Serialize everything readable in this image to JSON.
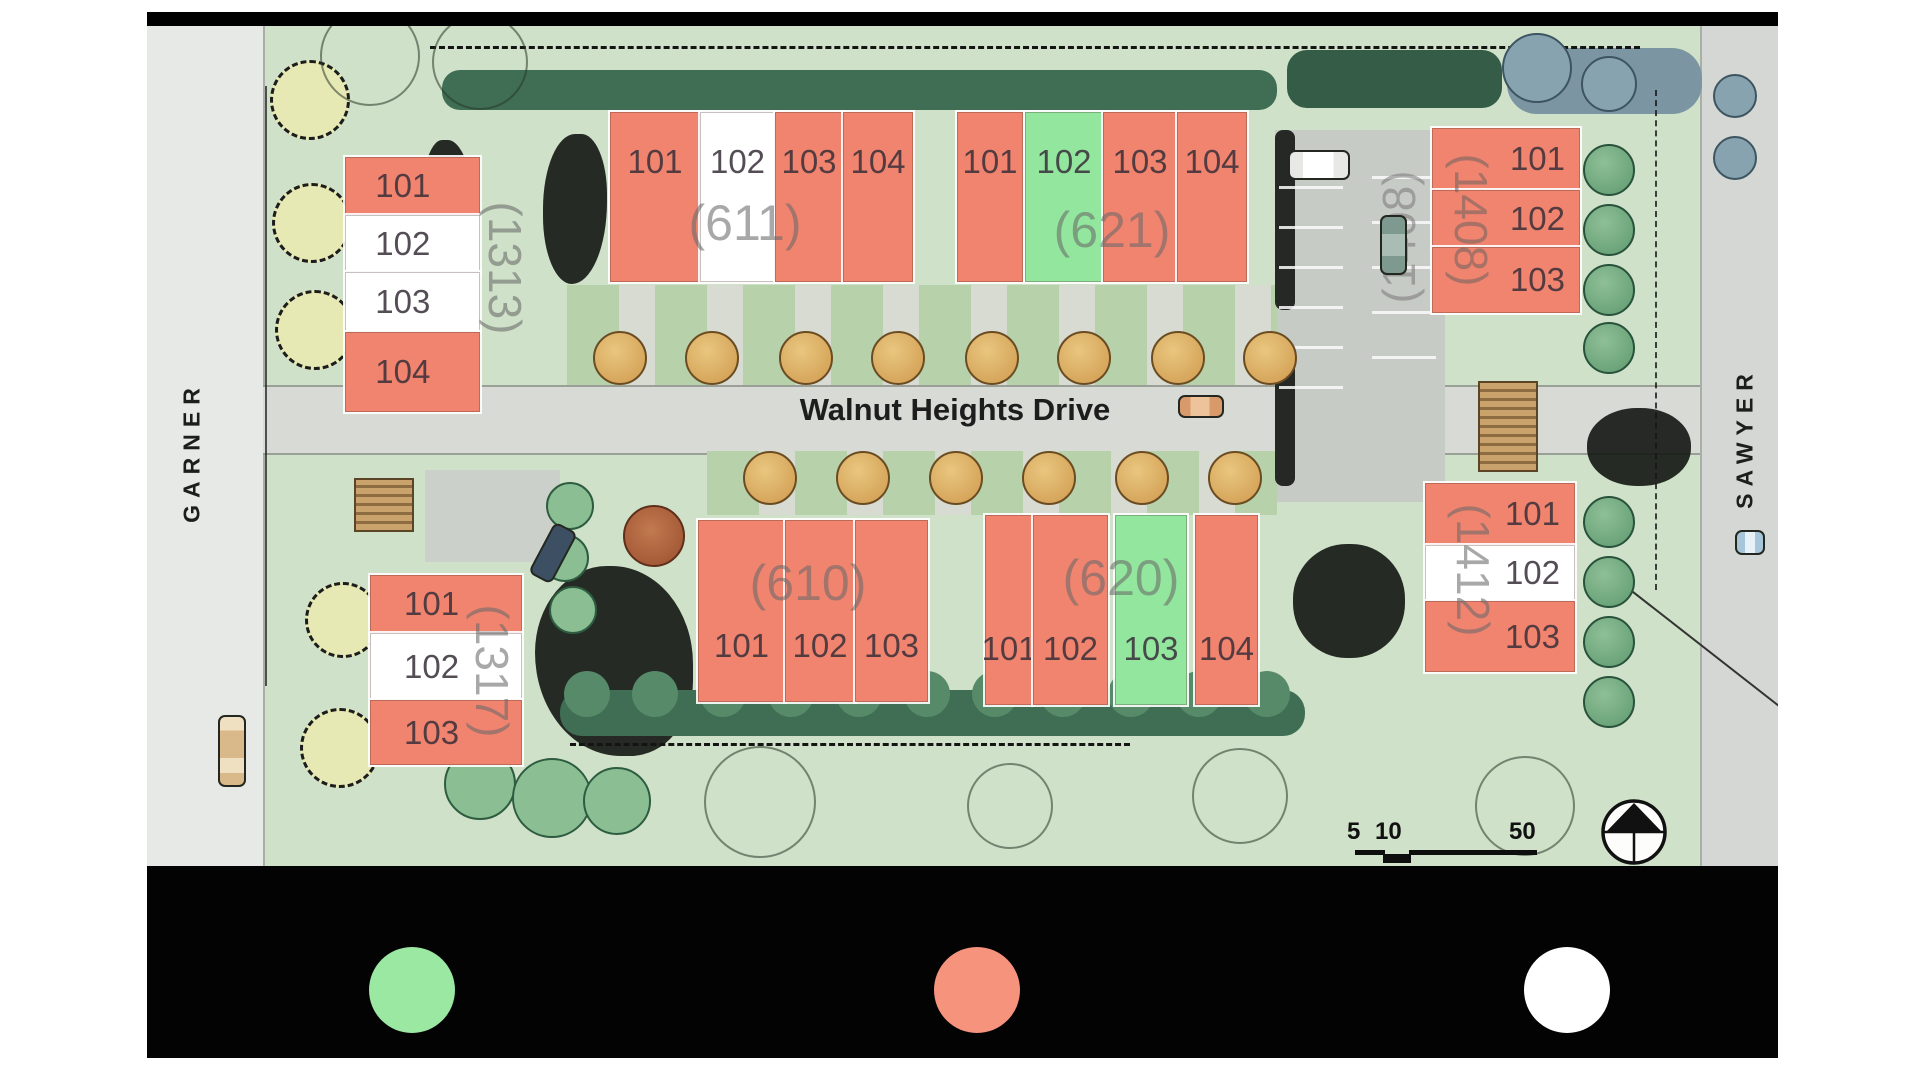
{
  "colors": {
    "salmon": "#F1846F",
    "green": "#93E69E",
    "white": "#FFFFFF"
  },
  "streets": {
    "left": "GARNER",
    "right": "SAWYER",
    "main": "Walnut Heights Drive"
  },
  "scale": {
    "labels": [
      "5",
      "10",
      "50"
    ]
  },
  "buildings": [
    {
      "id": "1313",
      "label": "(1313)",
      "units": [
        {
          "number": "101",
          "status": "salmon"
        },
        {
          "number": "102",
          "status": "white"
        },
        {
          "number": "103",
          "status": "white"
        },
        {
          "number": "104",
          "status": "salmon"
        }
      ]
    },
    {
      "id": "611",
      "label": "(611)",
      "units": [
        {
          "number": "101",
          "status": "salmon"
        },
        {
          "number": "102",
          "status": "white"
        },
        {
          "number": "103",
          "status": "salmon"
        },
        {
          "number": "104",
          "status": "salmon"
        }
      ]
    },
    {
      "id": "621",
      "label": "(621)",
      "units": [
        {
          "number": "101",
          "status": "salmon"
        },
        {
          "number": "102",
          "status": "green"
        },
        {
          "number": "103",
          "status": "salmon"
        },
        {
          "number": "104",
          "status": "salmon"
        }
      ]
    },
    {
      "id": "1408",
      "label": "(1408)",
      "partial_label": "(1408)",
      "units": [
        {
          "number": "101",
          "status": "salmon"
        },
        {
          "number": "102",
          "status": "salmon"
        },
        {
          "number": "103",
          "status": "salmon"
        }
      ]
    },
    {
      "id": "1317",
      "label": "(1317)",
      "units": [
        {
          "number": "101",
          "status": "salmon"
        },
        {
          "number": "102",
          "status": "white"
        },
        {
          "number": "103",
          "status": "salmon"
        }
      ]
    },
    {
      "id": "610",
      "label": "(610)",
      "units": [
        {
          "number": "101",
          "status": "salmon"
        },
        {
          "number": "102",
          "status": "salmon"
        },
        {
          "number": "103",
          "status": "salmon"
        }
      ]
    },
    {
      "id": "620",
      "label": "(620)",
      "units": [
        {
          "number": "101",
          "status": "salmon"
        },
        {
          "number": "102",
          "status": "salmon"
        },
        {
          "number": "103",
          "status": "green"
        },
        {
          "number": "104",
          "status": "salmon"
        }
      ]
    },
    {
      "id": "1412",
      "label": "(1412)",
      "units": [
        {
          "number": "101",
          "status": "salmon"
        },
        {
          "number": "102",
          "status": "white"
        },
        {
          "number": "103",
          "status": "salmon"
        }
      ]
    }
  ],
  "legend": {
    "swatches": [
      {
        "name": "green-circle",
        "color": "#9BE8A3"
      },
      {
        "name": "salmon-circle",
        "color": "#F6937D"
      },
      {
        "name": "white-circle",
        "color": "#FFFFFF"
      }
    ]
  }
}
